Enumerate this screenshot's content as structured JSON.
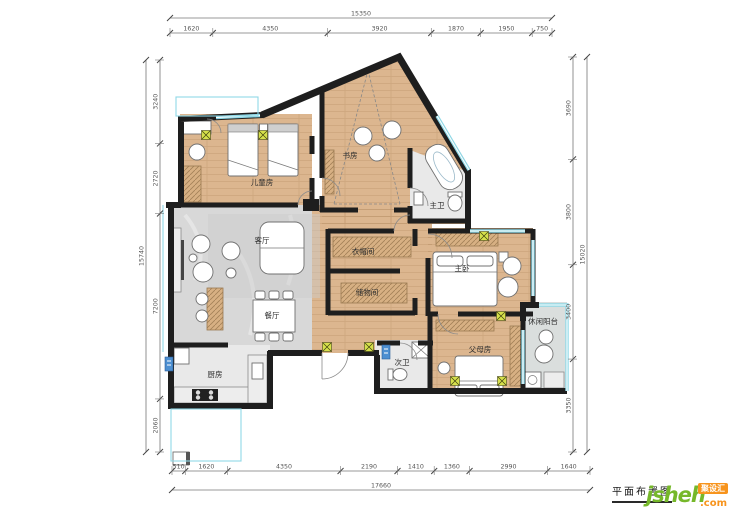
{
  "title": {
    "label": "平面布置图"
  },
  "logo": {
    "site_name": "jsheh",
    "site_tld": ".com",
    "badge": "聚设汇"
  },
  "rooms": [
    {
      "name": "儿童房"
    },
    {
      "name": "书房"
    },
    {
      "name": "主卫"
    },
    {
      "name": "客厅"
    },
    {
      "name": "衣帽间"
    },
    {
      "name": "主卧"
    },
    {
      "name": "储物间"
    },
    {
      "name": "餐厅"
    },
    {
      "name": "休闲阳台"
    },
    {
      "name": "厨房"
    },
    {
      "name": "次卫"
    },
    {
      "name": "父母房"
    }
  ],
  "dimensions": {
    "top": {
      "total": "15350",
      "segments": [
        "1620",
        "4350",
        "3920",
        "1870",
        "1950",
        "750"
      ]
    },
    "bottom": {
      "total": "17660",
      "segments": [
        "510",
        "1620",
        "4350",
        "2190",
        "1410",
        "1360",
        "2990",
        "1640"
      ]
    },
    "left": {
      "total": "15740",
      "segments": [
        "3240",
        "2720",
        "7200",
        "2060"
      ]
    },
    "right": {
      "total": "15020",
      "segments": [
        "3690",
        "3800",
        "3400",
        "3350"
      ]
    }
  },
  "colors": {
    "wall": "#1e1e1e",
    "wood": "#dcb68f",
    "marble": "#d8d8d8",
    "tile": "#e9e9e9",
    "balcony": "#dadedd",
    "window": "#8fd8e6",
    "cabinet": "#d7b083",
    "symbol": "#d6e04b",
    "brandGreen": "#76b82a",
    "brandOrange": "#f7941d"
  }
}
